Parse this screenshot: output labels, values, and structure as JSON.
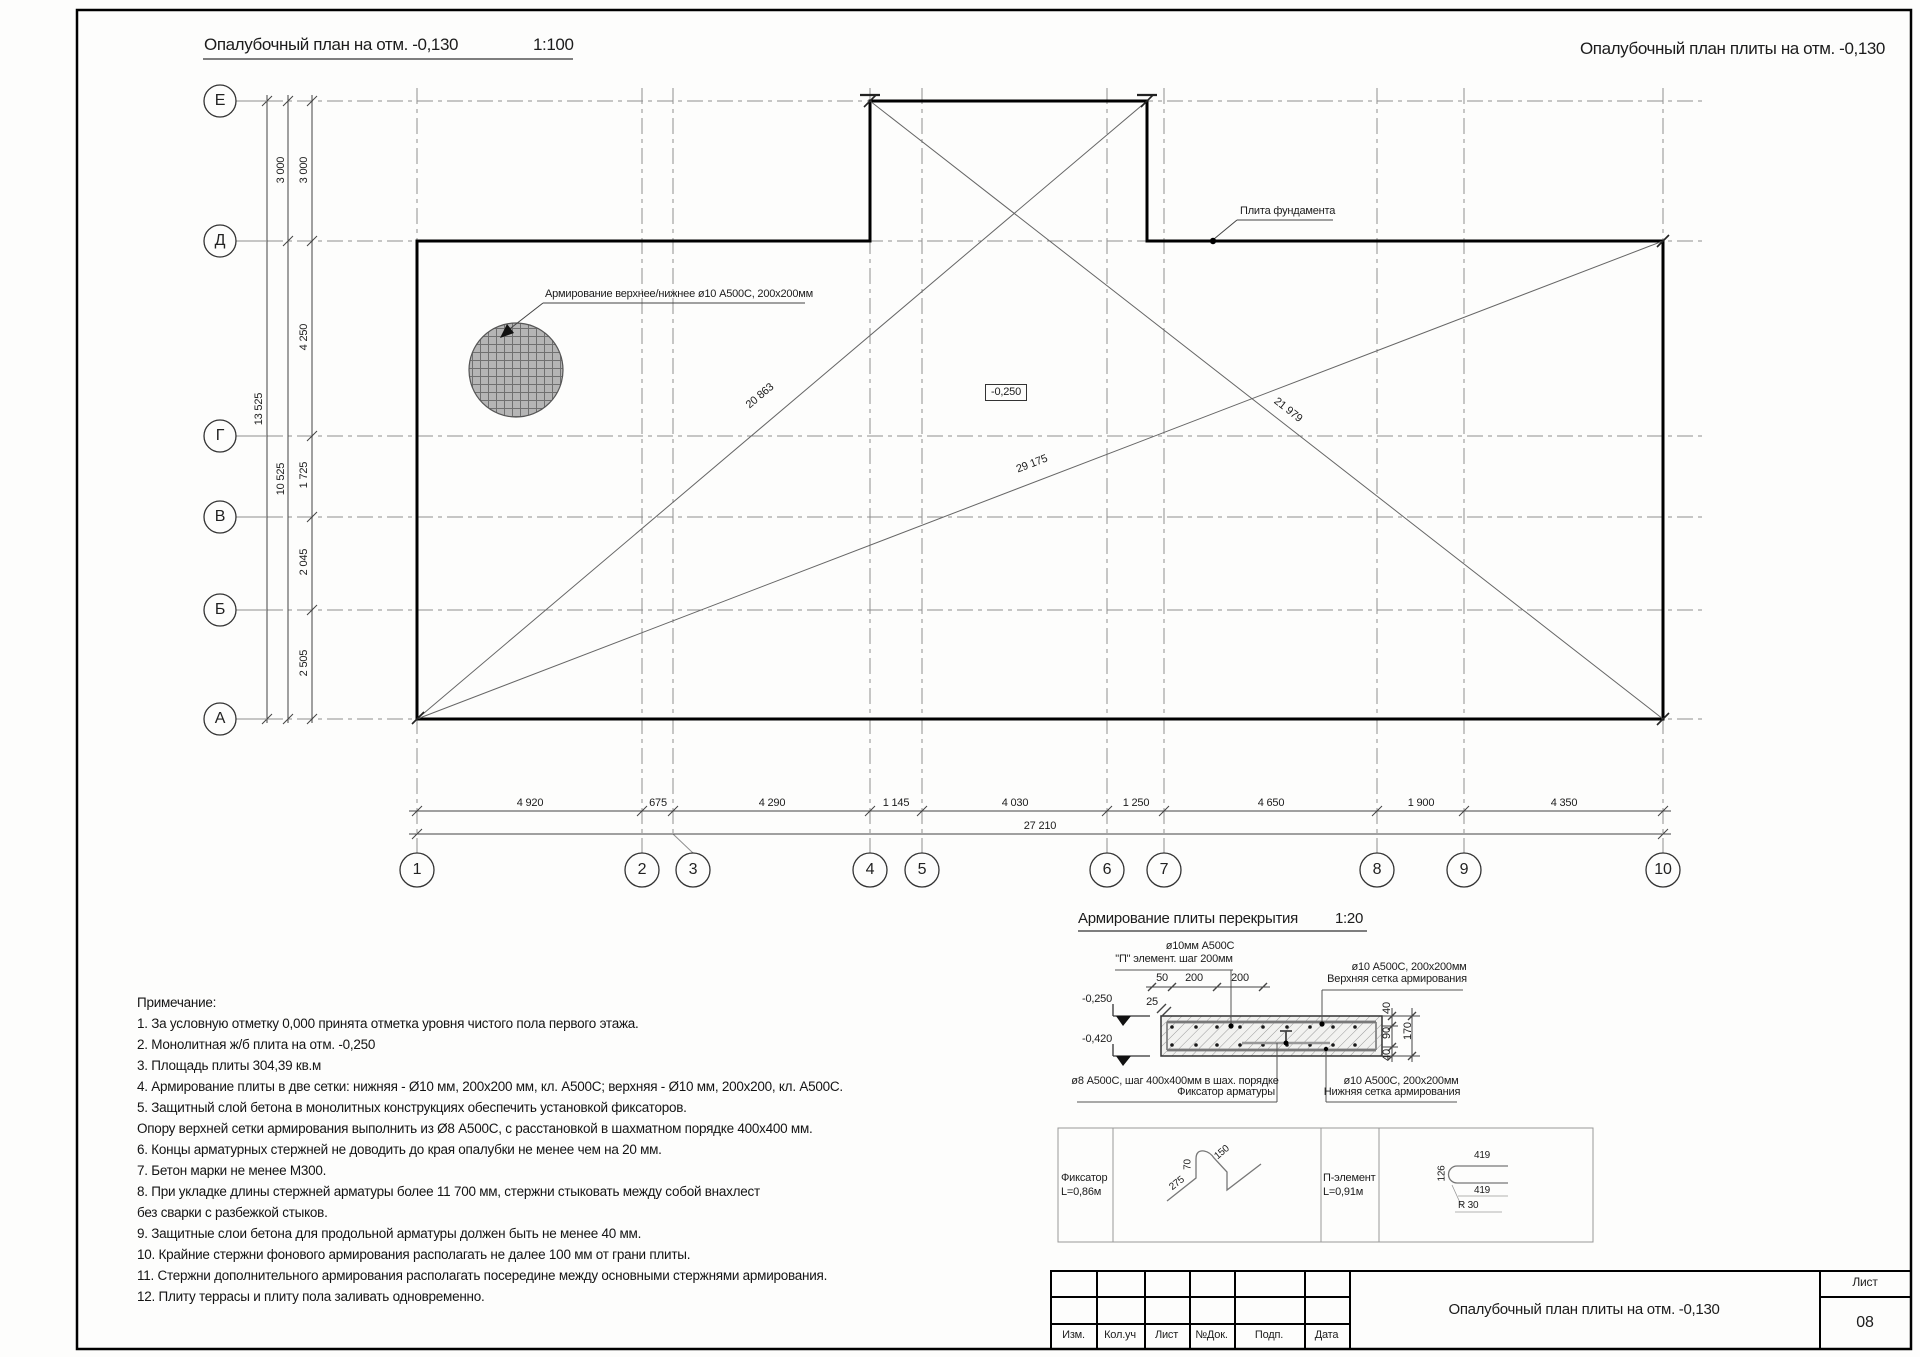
{
  "titles": {
    "plan_title": "Опалубочный план на отм. -0,130",
    "plan_scale": "1:100",
    "sheet_title": "Опалубочный план плиты на отм. -0,130"
  },
  "plan": {
    "row_axes": [
      "Е",
      "Д",
      "Г",
      "В",
      "Б",
      "А"
    ],
    "col_axes": [
      "1",
      "2",
      "3",
      "4",
      "5",
      "6",
      "7",
      "8",
      "9",
      "10"
    ],
    "left_dims": {
      "segments": [
        "3 000",
        "4 250",
        "1 725",
        "2 045",
        "2 505"
      ],
      "mid": [
        "3 000",
        "10 525"
      ],
      "total": "13 525"
    },
    "bottom_dims": {
      "segments": [
        "4 920",
        "675",
        "4 290",
        "1 145",
        "4 030",
        "1 250",
        "4 650",
        "1 900",
        "4 350"
      ],
      "total": "27 210"
    },
    "diag_dims": [
      "20 863",
      "29 175",
      "21 979"
    ],
    "level_mark": "-0,250",
    "mesh_note": "Армирование верхнее/нижнее ø10 А500С, 200х200мм",
    "slab_note": "Плита фундамента"
  },
  "section": {
    "title": "Армирование плиты перекрытия",
    "scale": "1:20",
    "top_note_1": "ø10мм А500С",
    "top_note_2": "\"П\" элемент.  шаг 200мм",
    "upper_mesh_1": "ø10 А500С, 200х200мм",
    "upper_mesh_2": "Верхняя сетка армирования",
    "fixator_1": "ø8 А500С, шаг 400х400мм в шах. порядке",
    "fixator_2": "Фиксатор арматуры",
    "lower_mesh_1": "ø10 А500С, 200х200мм",
    "lower_mesh_2": "Нижняя сетка армирования",
    "top_dims": [
      "50",
      "200",
      "200"
    ],
    "dim_25": "25",
    "lvl_top": "-0,250",
    "lvl_bot": "-0,420",
    "right_dims": [
      "40",
      "90",
      "40"
    ],
    "right_total": "170"
  },
  "details": {
    "fixator_label": "Фиксатор",
    "fixator_len": "L=0,86м",
    "fixator_dims": [
      "275",
      "70",
      "150"
    ],
    "p_label": "П-элемент",
    "p_len": "L=0,91м",
    "p_dim_top": "419",
    "p_dim_bottom": "419",
    "p_dim_left": "126",
    "p_dim_radius": "R 30"
  },
  "notes": {
    "header": "Примечание:",
    "lines": [
      "1. За условную отметку 0,000 принята отметка уровня чистого пола первого этажа.",
      "2. Монолитная ж/б плита  на отм. -0,250",
      "3. Площадь плиты 304,39 кв.м",
      "4. Армирование плиты в две сетки: нижняя - Ø10 мм, 200х200 мм, кл. А500С; верхняя - Ø10 мм, 200х200, кл. А500С.",
      "5. Защитный слой бетона в монолитных конструкциях обеспечить установкой фиксаторов.",
      "Опору верхней сетки армирования выполнить из Ø8 А500С, с расстановкой в шахматном порядке 400х400 мм.",
      "6. Концы арматурных стержней не доводить до края опалубки не менее чем на 20 мм.",
      "7. Бетон марки не менее М300.",
      "8. При укладке длины стержней арматуры более 11 700 мм, стержни стыковать между собой внахлест",
      "без сварки с разбежкой стыков.",
      "9. Защитные слои бетона для продольной арматуры должен быть не менее 40 мм.",
      "10. Крайние стержни фонового армирования располагать не далее 100 мм от грани плиты.",
      "11. Стержни дополнительного армирования располагать посередине между основными стержнями армирования.",
      "12. Плиту террасы и плиту пола заливать одновременно."
    ]
  },
  "titleblock": {
    "cols": [
      "Изм.",
      "Кол.уч",
      "Лист",
      "№Док.",
      "Подп.",
      "Дата"
    ],
    "doc_title": "Опалубочный план плиты на отм. -0,130",
    "sheet_label": "Лист",
    "sheet_number": "08"
  }
}
